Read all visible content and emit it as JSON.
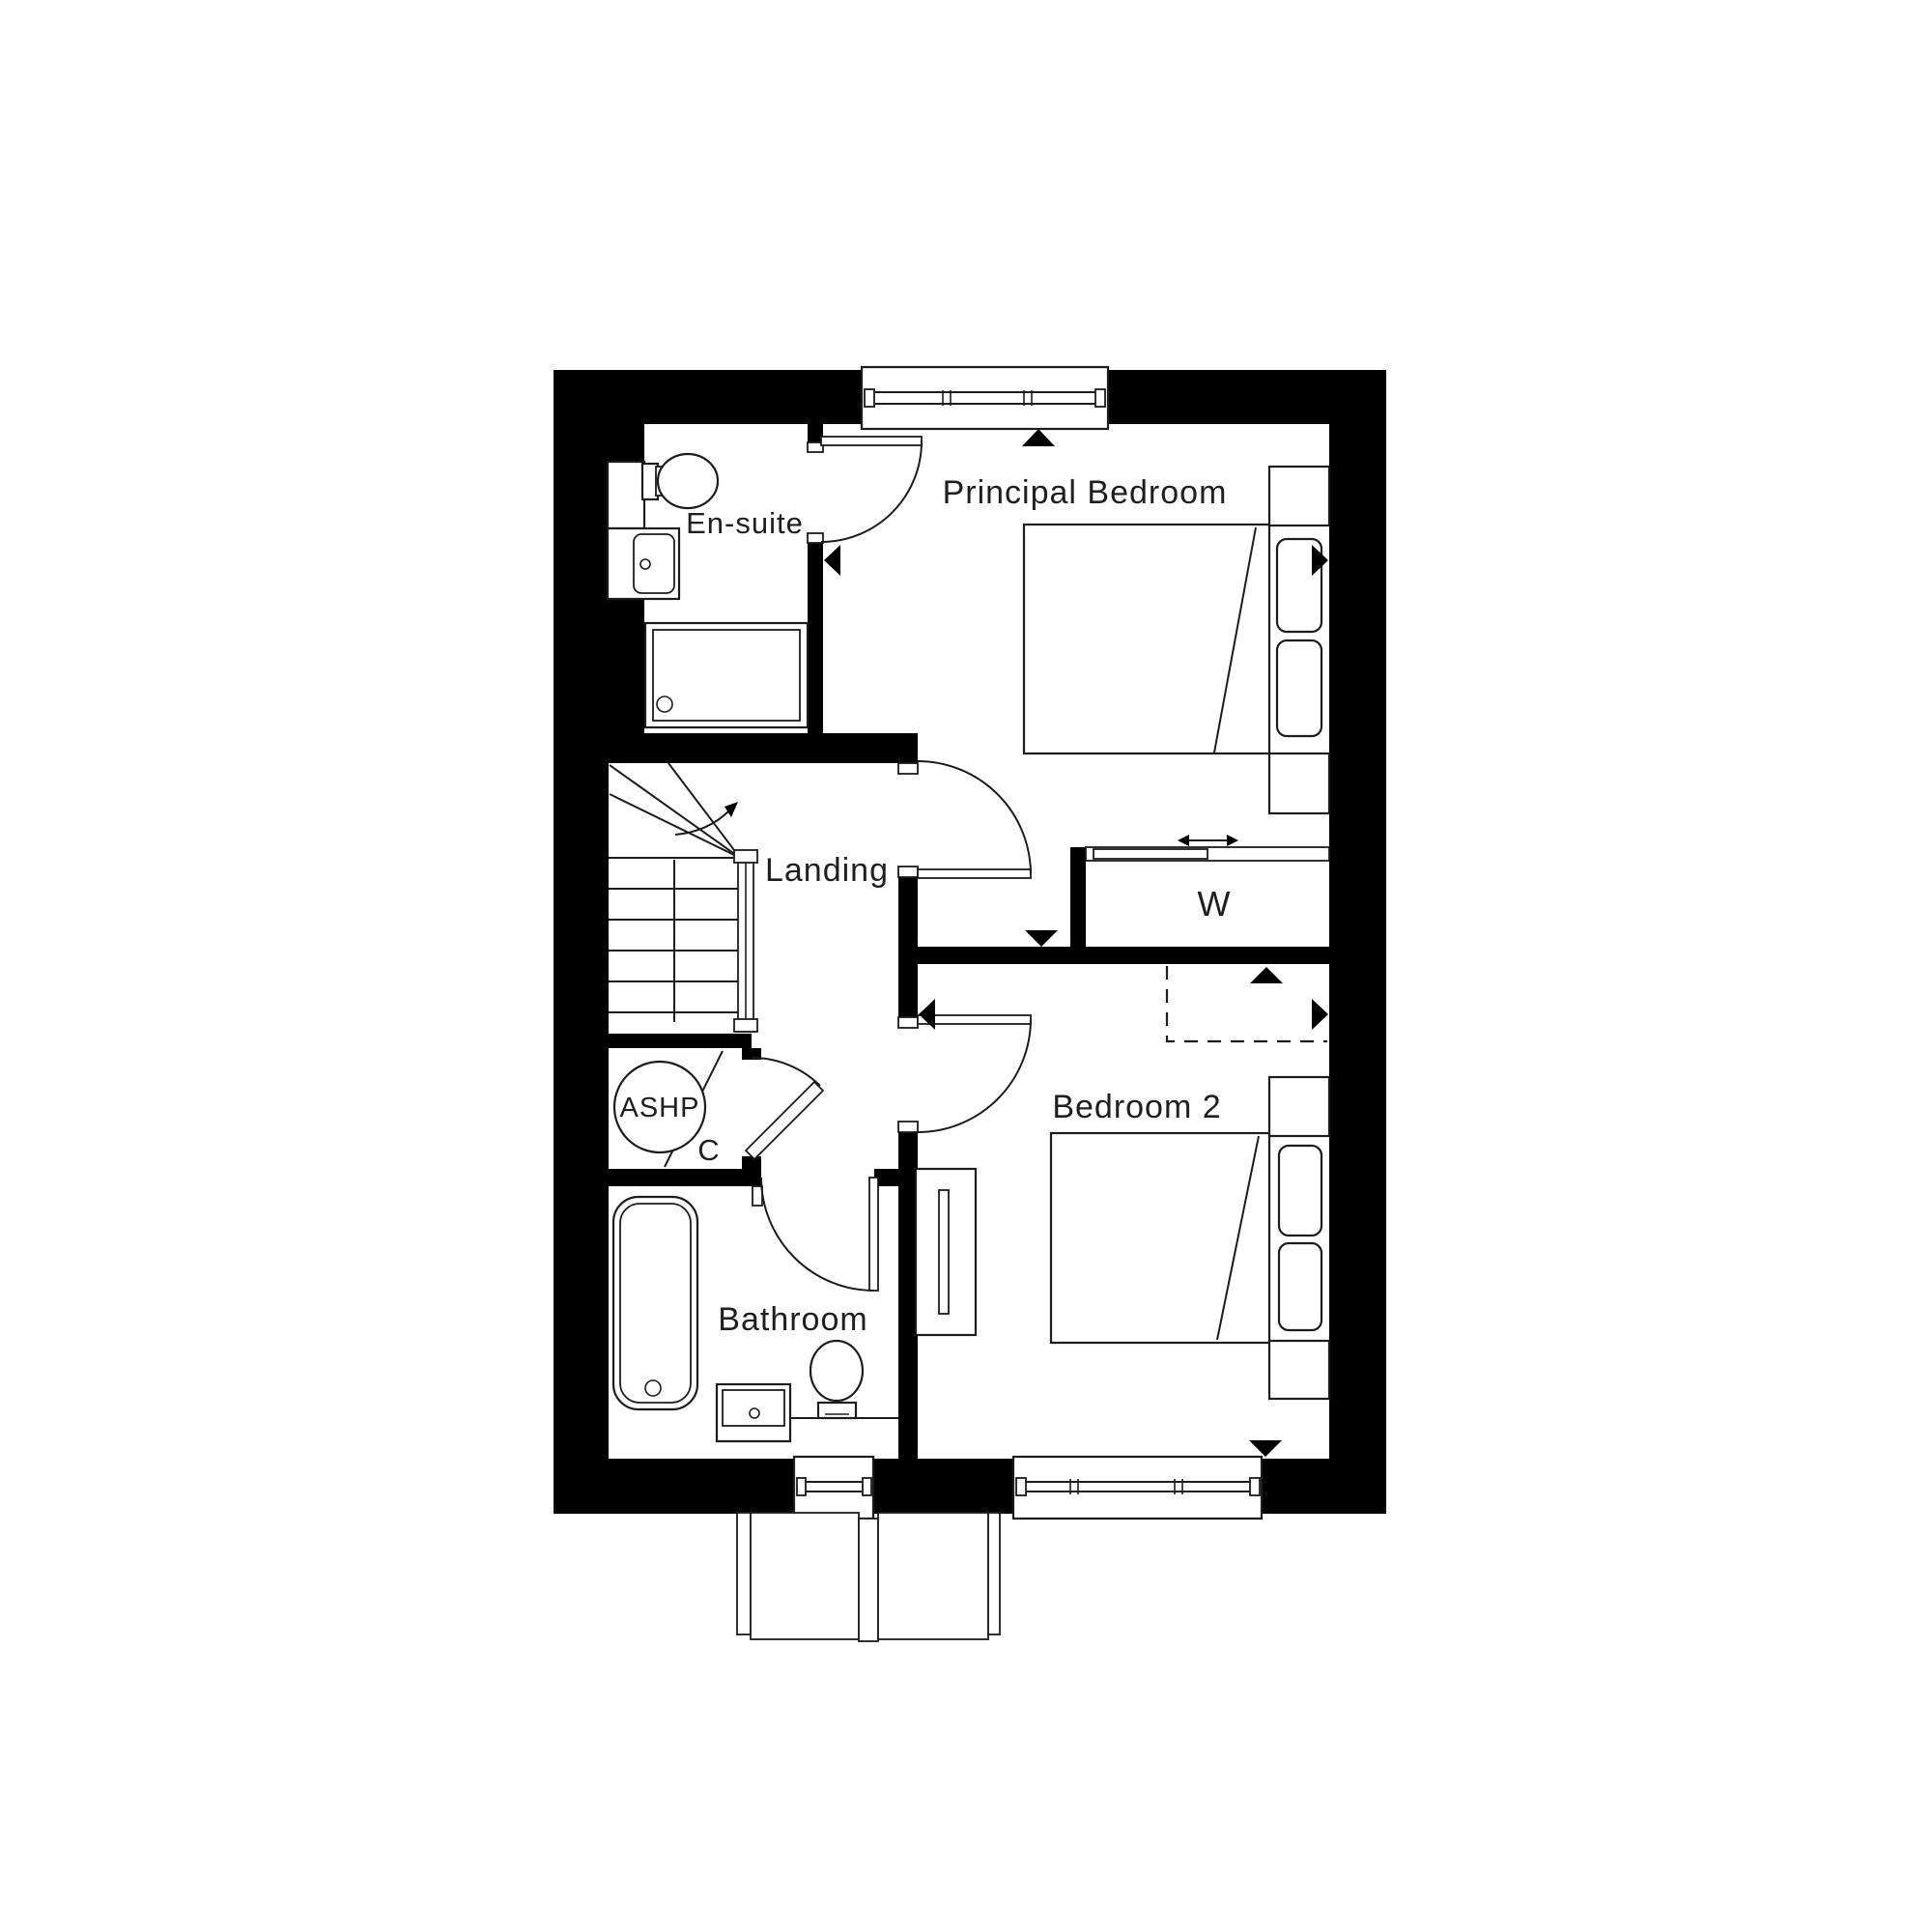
{
  "plan": {
    "type": "floor-plan",
    "floor": "first-floor",
    "colors": {
      "wall": "#000000",
      "line": "#1c1c1c",
      "background": "#ffffff",
      "text": "#1f1f1f"
    },
    "rooms": {
      "principal_bedroom": {
        "label": "Principal Bedroom"
      },
      "en_suite": {
        "label": "En-suite"
      },
      "landing": {
        "label": "Landing"
      },
      "wardrobe": {
        "label": "W"
      },
      "bedroom_2": {
        "label": "Bedroom 2"
      },
      "ashp": {
        "label": "ASHP"
      },
      "cupboard": {
        "label": "C"
      },
      "bathroom": {
        "label": "Bathroom"
      }
    },
    "fixtures": [
      "ensuite-toilet",
      "ensuite-basin",
      "shower-tray",
      "staircase-with-up-arrow",
      "ashp-unit-circle",
      "bath",
      "bathroom-basin",
      "bathroom-toilet",
      "principal-double-bed",
      "bedside-cabinets",
      "sliding-wardrobe",
      "bedroom2-double-bed",
      "chest-of-drawers",
      "top-window",
      "bathroom-window",
      "bedroom2-window",
      "door-swings",
      "dimension-arrow-markers",
      "dashed-bulkhead-zone",
      "porch-outline-below"
    ]
  }
}
